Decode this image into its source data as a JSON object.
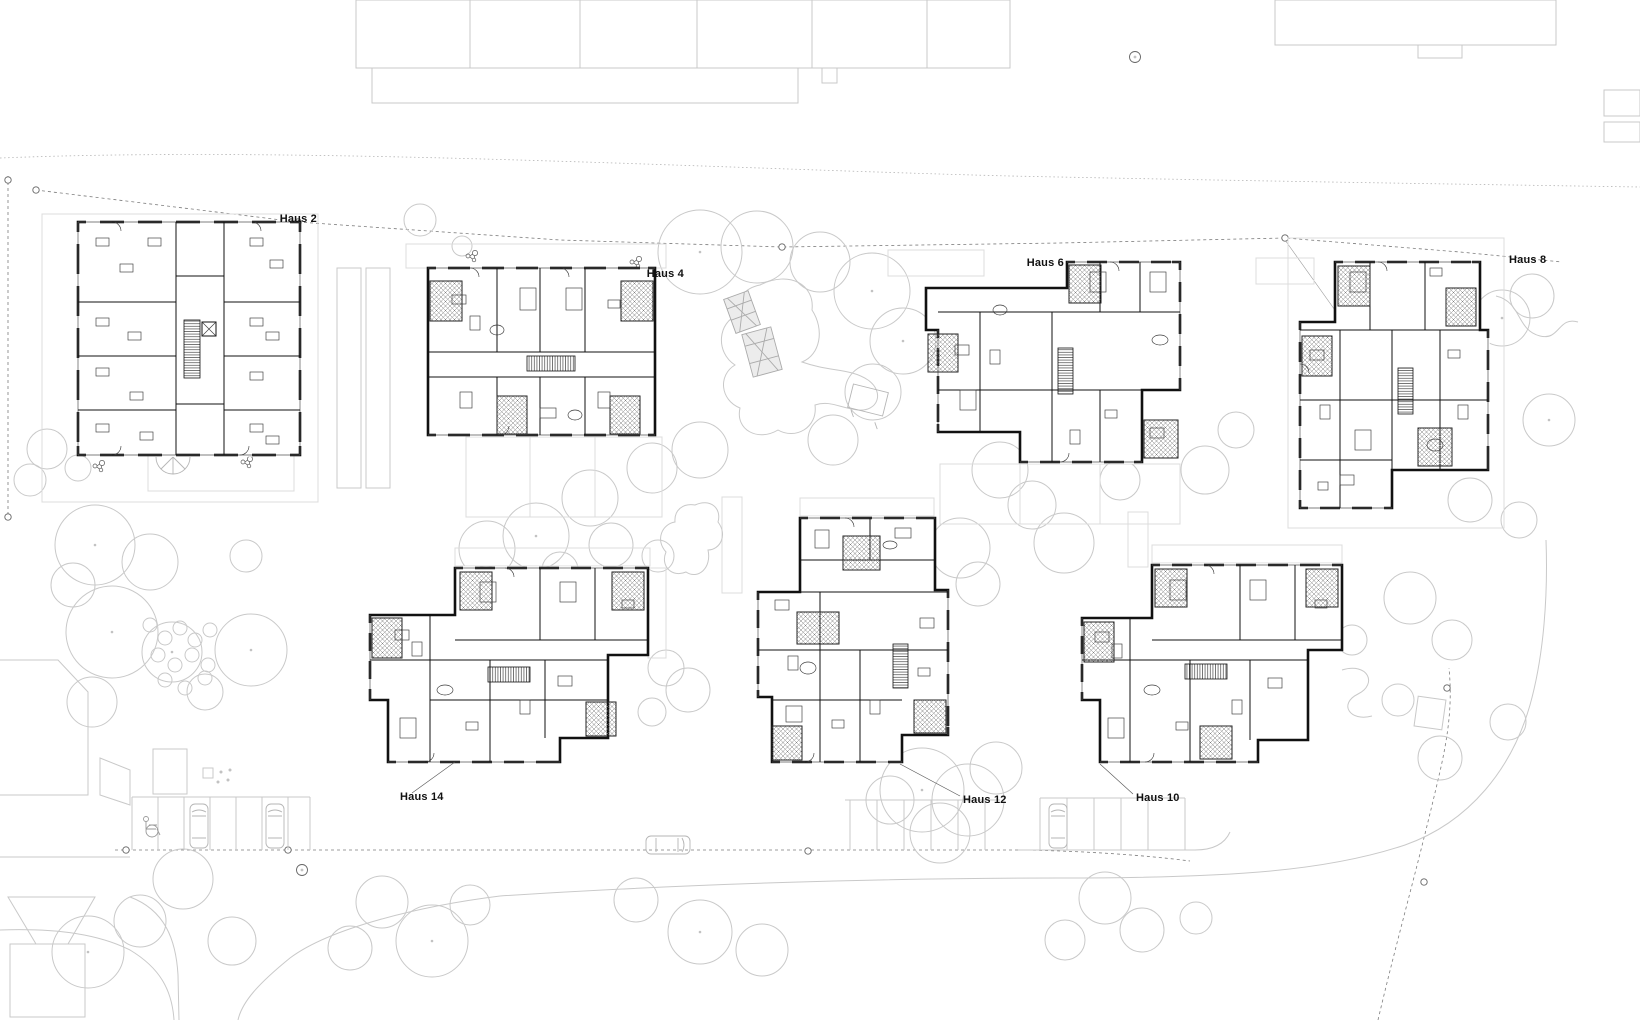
{
  "drawing": {
    "kind": "architectural-site-plan",
    "buildings": [
      {
        "id": "haus-2",
        "label": "Haus 2"
      },
      {
        "id": "haus-4",
        "label": "Haus 4"
      },
      {
        "id": "haus-6",
        "label": "Haus 6"
      },
      {
        "id": "haus-8",
        "label": "Haus 8"
      },
      {
        "id": "haus-10",
        "label": "Haus 10"
      },
      {
        "id": "haus-12",
        "label": "Haus 12"
      },
      {
        "id": "haus-14",
        "label": "Haus 14"
      }
    ],
    "colors": {
      "background": "#ffffff",
      "building_line": "#111111",
      "site_context_line": "#c9c9c9",
      "boundary_line": "#7d7d7d",
      "label_text": "#111111"
    }
  }
}
